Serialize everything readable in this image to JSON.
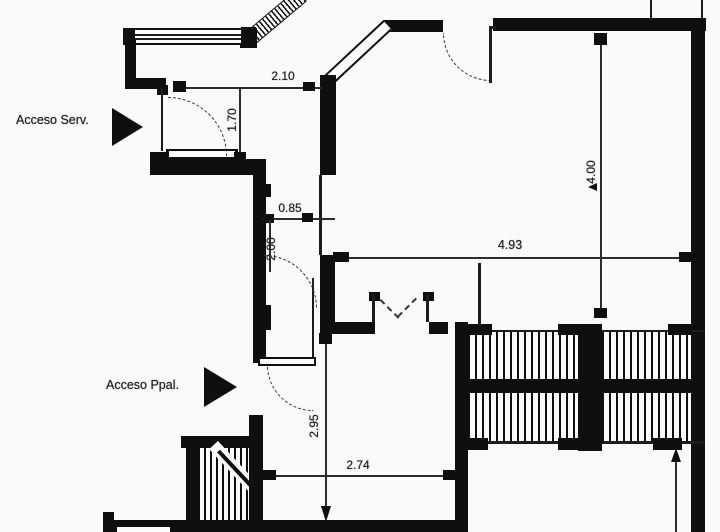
{
  "labels": {
    "acceso_serv": "Acceso Serv.",
    "acceso_ppal": "Acceso Ppal."
  },
  "dimensions": {
    "serv_opening_width": "2.10",
    "serv_room_depth": "1.70",
    "corridor_width": "0.85",
    "corridor_length": "2.00",
    "main_room_width": "4.93",
    "main_room_depth": "4.00",
    "hall_depth": "2.95",
    "hall_width": "2.74"
  },
  "icons": {
    "serv_arrow": "right-triangle-arrow",
    "ppal_arrow": "right-triangle-arrow"
  },
  "colors": {
    "ink": "#0d0d0d",
    "dimension_line": "#2a2a2a",
    "background": "#fcfcfc"
  }
}
